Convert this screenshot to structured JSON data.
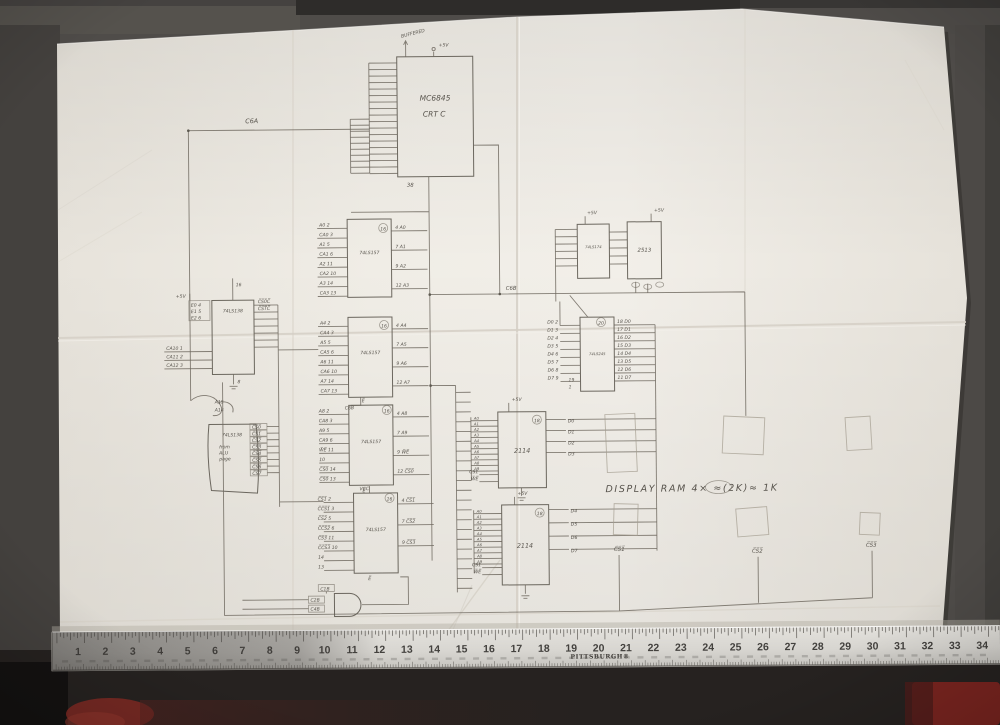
{
  "schematic": {
    "nets": {
      "c6a": "C6A",
      "c6b": "C6B"
    },
    "crtc": {
      "name": "MC6845",
      "sub": "CRT C",
      "top_note": "BUFFERED",
      "vcc": "+5V",
      "pin_bottom": "38"
    },
    "mux_a": {
      "name": "74LS157",
      "pin_top": "16",
      "left": [
        "A0 2",
        "CA0 3",
        "A1 5",
        "CA1 6",
        "A2 11",
        "CA2 10",
        "A3 14",
        "CA3 13"
      ],
      "right": [
        "4 A0",
        "7 A1",
        "9 A2",
        "12 A3"
      ]
    },
    "mux_b": {
      "name": "74LS157",
      "pin_top": "16",
      "enable": "E̅",
      "enable_net": "C6B",
      "left": [
        "A4 2",
        "CA4 3",
        "A5 5",
        "CA5 6",
        "A6 11",
        "CA6 10",
        "A7 14",
        "CA7 13"
      ],
      "right": [
        "4 A4",
        "7 A5",
        "9 A6",
        "12 A7"
      ]
    },
    "mux_c": {
      "name": "74LS157",
      "pin_top": "16",
      "enable": "E̅",
      "left": [
        "A8 2",
        "CA8 3",
        "A9 5",
        "CA9 6",
        "W̅E̅ 11",
        "10",
        "C̅S̅0̅ 14",
        "C̅S̅0̅ 13"
      ],
      "right": [
        "4 A8",
        "7 A9",
        "9 W̅E̅",
        "12 C̅S̅0̅"
      ]
    },
    "mux_d": {
      "name": "74LS157",
      "pin_top": "16",
      "vcc": "VCC",
      "enable": "E̅",
      "left": [
        "C̅S̅1̅ 2",
        "C̅C̅S̅1̅ 3",
        "C̅S̅2̅ 5",
        "C̅C̅S̅2̅ 6",
        "C̅S̅3̅ 11",
        "C̅C̅S̅3̅ 10",
        "14",
        "13"
      ],
      "right": [
        "4 C̅S̅1̅",
        "7 C̅S̅2̅",
        "9 C̅S̅3̅"
      ]
    },
    "decoder1": {
      "name": "74LS138",
      "vcc": "+5V",
      "pin_top": "16",
      "gnd": "8",
      "enables": [
        "E0 4",
        "E1 5",
        "E2 6"
      ],
      "left": [
        "CA10 1",
        "CA11 2",
        "CA12 3"
      ],
      "out_labels": [
        "C̅S̅0̅C̅",
        "C̅S̅T̅C̅"
      ]
    },
    "decoder2": {
      "name": "74LS138",
      "note_lines": [
        "from",
        "ALU",
        "page"
      ],
      "top_nets": [
        "A15",
        "A14"
      ],
      "outputs": [
        "C̅S̅0̅",
        "C̅S̅1̅",
        "C̅S̅2̅",
        "C̅S̅3̅",
        "C̅S̅4̅",
        "C̅S̅5̅",
        "C̅S̅6̅",
        "C̅S̅7̅"
      ]
    },
    "ff": {
      "name": "74LS174",
      "vcc": "+5V"
    },
    "chargen": {
      "name": "2513",
      "vcc": "+5V"
    },
    "xcvr": {
      "name": "74LS245",
      "pin_top": "20",
      "left": [
        "D0 2",
        "D1 3",
        "D2 4",
        "D3 5",
        "D4 6",
        "D5 7",
        "D6 8",
        "D7 9"
      ],
      "right": [
        "18 D0",
        "17 D1",
        "16 D2",
        "15 D3",
        "14 D4",
        "13 D5",
        "12 D6",
        "11 D7"
      ],
      "bottom": [
        "19",
        "1"
      ]
    },
    "ram1": {
      "name": "2114",
      "pin_top": "18",
      "vcc": "+5V",
      "addr": [
        "A0",
        "A1",
        "A2",
        "A3",
        "A4",
        "A5",
        "A6",
        "A7",
        "A8",
        "A9"
      ],
      "ctl": [
        "CS1",
        "W̅E̅"
      ],
      "data": [
        "D0",
        "D1",
        "D2",
        "D3"
      ]
    },
    "ram2": {
      "name": "2114",
      "pin_top": "18",
      "vcc": "+5V",
      "addr": [
        "A0",
        "A1",
        "A2",
        "A3",
        "A4",
        "A5",
        "A6",
        "A7",
        "A8",
        "A9"
      ],
      "ctl": [
        "CS1",
        "W̅E̅"
      ],
      "data": [
        "D4",
        "D5",
        "D6",
        "D7"
      ]
    },
    "note": "DISPLAY  RAM  4× ≈(2K)≈ 1K",
    "cs_labels": [
      "C̅S̅1̅",
      "C̅S̅2̅",
      "C̅S̅3̅"
    ],
    "gate": {
      "top": "C1B",
      "inputs": [
        "C2B",
        "C4B"
      ]
    }
  },
  "ruler": {
    "brand": "PITTSBURGH®",
    "inches": [
      "1",
      "2",
      "3",
      "4",
      "5",
      "6",
      "7",
      "8",
      "9",
      "10",
      "11",
      "12",
      "13",
      "14",
      "15",
      "16",
      "17",
      "18",
      "19",
      "20",
      "21",
      "22",
      "23",
      "24",
      "25",
      "26",
      "27",
      "28",
      "29",
      "30",
      "31",
      "32",
      "33",
      "34"
    ]
  }
}
